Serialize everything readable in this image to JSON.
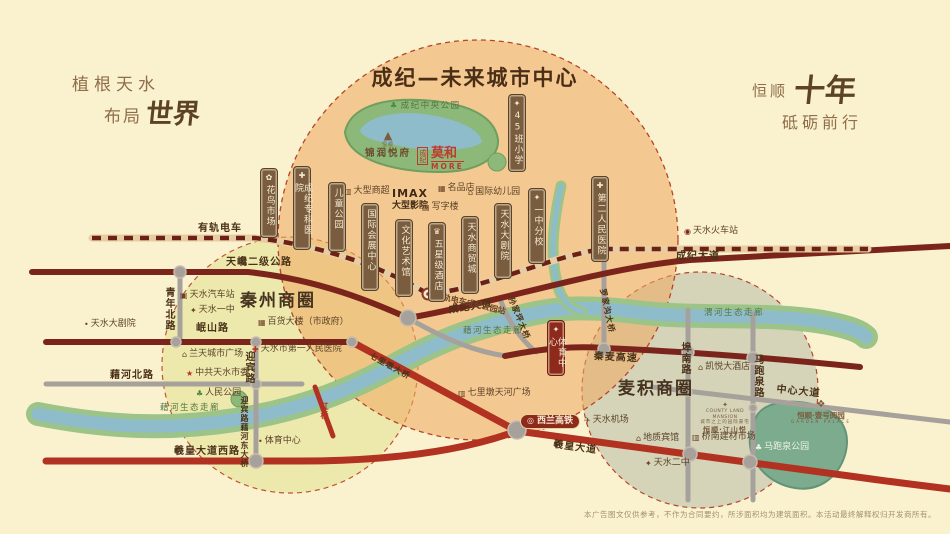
{
  "slogans": {
    "left_line1": "植根天水",
    "left_line2_prefix": "布局",
    "left_line2_calligraphy": "世界",
    "right_prefix": "恒顺",
    "right_calligraphy": "十年",
    "right_line2": "砥砺前行"
  },
  "header": {
    "center_title": "成纪—未来城市中心"
  },
  "badges": {
    "hsr": "西兰高铁",
    "imax_line1": "IMAX",
    "imax_line2": "大型影院"
  },
  "logos": {
    "jinrun": {
      "brand": "恒顺",
      "name": "锦润悦府"
    },
    "moka": {
      "prefix": "成纪",
      "name": "莫和",
      "latin": "MORE"
    },
    "county": {
      "latin": "COUNTY LAND MANSION",
      "tagline": "城市之上的园际豪宅",
      "name": "恒顺·江山悦"
    },
    "yueyuan": {
      "name": "恒顺·壹号阅园",
      "latin": "GARDEN PALACE"
    }
  },
  "disclaimer": "本广告图文仅供参考，不作为合同要约，所涉面积均为建筑面积。本活动最终解释权归开发商所有。",
  "colors": {
    "background": "#faf2cf",
    "center_circle": "#eea75f",
    "qinzhou_circle": "#e0e08c",
    "maiji_circle": "#b0b6a2",
    "circle_border": "#b5452c",
    "road_major": "#7b241c",
    "road_artery": "#b23222",
    "road_minor": "#a7a19b",
    "tram_dash": "#6d2014",
    "river_water": "#8fbccb",
    "river_bank": "#9cc489",
    "park_green": "#8cb97a",
    "park_teal": "#7cab8e",
    "plaque_brown": "#7a5c3e",
    "plaque_red": "#8d2a1c",
    "logo_red": "#c0392b",
    "text_dark": "#4a3118",
    "slogan_brown": "#8f6e49",
    "disclaimer_color": "#a3906c"
  },
  "plaques": [
    {
      "text": "花鸟市场",
      "icon": "flower",
      "x": 260,
      "y": 168,
      "h": 70
    },
    {
      "text": "成纪专科医院",
      "icon": "hospital",
      "x": 293,
      "y": 166,
      "h": 84
    },
    {
      "text": "儿童公园",
      "x": 328,
      "y": 182,
      "h": 70
    },
    {
      "text": "国际会展中心",
      "x": 361,
      "y": 203,
      "h": 88
    },
    {
      "text": "文化艺术馆",
      "x": 395,
      "y": 219,
      "h": 78
    },
    {
      "text": "五星级酒店",
      "icon": "crown",
      "x": 428,
      "y": 222,
      "h": 80
    },
    {
      "text": "天水商贸城",
      "x": 461,
      "y": 216,
      "h": 78
    },
    {
      "text": "天水大剧院",
      "x": 494,
      "y": 203,
      "h": 76
    },
    {
      "text": "一中分校",
      "icon": "school",
      "x": 528,
      "y": 188,
      "h": 76
    },
    {
      "text": "第二人民医院",
      "icon": "hospital",
      "x": 591,
      "y": 176,
      "h": 86
    },
    {
      "text": "45班小学",
      "icon": "school",
      "x": 508,
      "y": 94,
      "h": 78
    },
    {
      "text": "体育中心",
      "icon": "torch",
      "x": 547,
      "y": 320,
      "h": 56,
      "variant": "red"
    }
  ],
  "map_labels": [
    {
      "name": "tram-label",
      "text": "有轨电车",
      "cls": "road",
      "x": 198,
      "y": 224
    },
    {
      "name": "road-tianchan",
      "text": "天巉二级公路",
      "cls": "road",
      "x": 226,
      "y": 258
    },
    {
      "name": "road-chengji-east",
      "text": "成纪大道",
      "cls": "road",
      "x": 676,
      "y": 252
    },
    {
      "name": "road-chengji-mid",
      "text": "成纪大道",
      "cls": "road",
      "x": 448,
      "y": 306,
      "rot": -9
    },
    {
      "name": "road-minshan",
      "text": "岷山路",
      "cls": "road",
      "x": 196,
      "y": 324
    },
    {
      "name": "road-qingnian",
      "text": "青年北路",
      "cls": "road vert",
      "x": 163,
      "y": 287
    },
    {
      "name": "road-jihe-north",
      "text": "藉河北路",
      "cls": "road",
      "x": 110,
      "y": 371
    },
    {
      "name": "road-yingbin",
      "text": "迎宾路",
      "cls": "road vert",
      "x": 243,
      "y": 351
    },
    {
      "name": "bridge-yingbin-jihe",
      "text": "迎宾路藉河东大桥",
      "cls": "road vert small",
      "x": 240,
      "y": 396
    },
    {
      "name": "road-xihuang-west",
      "text": "羲皇大道西路",
      "cls": "road",
      "x": 174,
      "y": 447
    },
    {
      "name": "road-xihuang",
      "text": "羲皇大道",
      "cls": "road",
      "x": 554,
      "y": 440,
      "rot": 8
    },
    {
      "name": "road-qinmai-expwy",
      "text": "秦麦高速",
      "cls": "road",
      "x": 594,
      "y": 352,
      "rot": 3
    },
    {
      "name": "road-zhongxin",
      "text": "中心大道",
      "cls": "road",
      "x": 777,
      "y": 385,
      "rot": 6
    },
    {
      "name": "road-bunan",
      "text": "埠南路",
      "cls": "road vert",
      "x": 679,
      "y": 342
    },
    {
      "name": "road-mapaoquan",
      "text": "马跑泉路",
      "cls": "road vert",
      "x": 752,
      "y": 354
    },
    {
      "name": "bridge-hongqiao",
      "text": "红桥",
      "cls": "road vert red small",
      "x": 320,
      "y": 402
    },
    {
      "name": "bridge-qilidun",
      "text": "七里墩大桥",
      "cls": "road small",
      "x": 372,
      "y": 352,
      "rot": 29
    },
    {
      "name": "bridge-sunjiaping",
      "text": "孙家坪大桥",
      "cls": "road small",
      "x": 514,
      "y": 296,
      "rot": 68
    },
    {
      "name": "bridge-luojiagou",
      "text": "罗家沟大桥",
      "cls": "road small",
      "x": 606,
      "y": 288,
      "rot": 78
    },
    {
      "name": "tram-station-label",
      "text": "有轨电车成纪公园站",
      "cls": "station",
      "x": 436,
      "y": 292,
      "rot": 13
    },
    {
      "name": "qinzhou-circle-label",
      "text": "秦州商圈",
      "cls": "big",
      "x": 240,
      "y": 293
    },
    {
      "name": "maiji-circle-label",
      "text": "麦积商圈",
      "cls": "big",
      "x": 618,
      "y": 381
    },
    {
      "name": "river-jihe-corridor-1",
      "text": "藉河生态走廊",
      "cls": "river",
      "x": 160,
      "y": 404
    },
    {
      "name": "river-jihe-corridor-2",
      "text": "藉河生态走廊",
      "cls": "river",
      "x": 463,
      "y": 327
    },
    {
      "name": "river-weihe-corridor",
      "text": "渭河生态走廊",
      "cls": "river",
      "x": 704,
      "y": 309
    },
    {
      "name": "park-chengji-central",
      "text": "成纪中央公园",
      "cls": "river",
      "icon": "tree",
      "x": 390,
      "y": 102
    },
    {
      "name": "poi-grand-theater",
      "text": "天水大剧院",
      "cls": "poi",
      "icon": "dot",
      "x": 84,
      "y": 320
    },
    {
      "name": "poi-bus-station",
      "text": "天水汽车站",
      "cls": "poi",
      "icon": "bus",
      "x": 180,
      "y": 291
    },
    {
      "name": "poi-no1-middle-school",
      "text": "天水一中",
      "cls": "poi",
      "icon": "school",
      "x": 190,
      "y": 306
    },
    {
      "name": "poi-department-store",
      "text": "百货大楼（市政府）",
      "cls": "poi",
      "icon": "shop",
      "x": 258,
      "y": 318
    },
    {
      "name": "poi-lantian-plaza",
      "text": "兰天城市广场",
      "cls": "poi",
      "icon": "building",
      "x": 182,
      "y": 350
    },
    {
      "name": "poi-first-peoples-hospital",
      "text": "天水市第一人民医院",
      "cls": "poi",
      "icon": "hospital",
      "x": 252,
      "y": 345
    },
    {
      "name": "poi-municipal-committee",
      "text": "中共天水市委",
      "cls": "poi",
      "icon": "star",
      "x": 186,
      "y": 369
    },
    {
      "name": "poi-peoples-park",
      "text": "人民公园",
      "cls": "poi",
      "icon": "tree",
      "x": 196,
      "y": 389
    },
    {
      "name": "poi-sports-center-west",
      "text": "体育中心",
      "cls": "poi",
      "icon": "dot",
      "x": 258,
      "y": 437
    },
    {
      "name": "poi-supermarket",
      "text": "大型商超",
      "cls": "poi",
      "icon": "cart",
      "x": 344,
      "y": 187
    },
    {
      "name": "poi-boutique-store",
      "text": "名品店",
      "cls": "poi",
      "icon": "shop",
      "x": 438,
      "y": 184
    },
    {
      "name": "poi-intl-kindergarten",
      "text": "国际幼儿园",
      "cls": "poi",
      "icon": "building",
      "x": 468,
      "y": 188
    },
    {
      "name": "poi-office-tower",
      "text": "写字楼",
      "cls": "poi",
      "icon": "office",
      "x": 422,
      "y": 203
    },
    {
      "name": "poi-railway-station",
      "text": "天水火车站",
      "cls": "poi",
      "icon": "train",
      "x": 684,
      "y": 227
    },
    {
      "name": "poi-airport",
      "text": "天水机场",
      "cls": "poi",
      "icon": "plane",
      "x": 584,
      "y": 416
    },
    {
      "name": "poi-tianhe-plaza",
      "text": "七里墩天河广场",
      "cls": "poi",
      "icon": "cart",
      "x": 458,
      "y": 389
    },
    {
      "name": "poi-kaiyue-hotel",
      "text": "凯悦大酒店",
      "cls": "poi",
      "icon": "building",
      "x": 698,
      "y": 363
    },
    {
      "name": "poi-dizhi-hotel",
      "text": "地质宾馆",
      "cls": "poi",
      "icon": "building",
      "x": 636,
      "y": 434
    },
    {
      "name": "poi-qiaonan-market",
      "text": "桥南建材市场",
      "cls": "poi",
      "icon": "cart",
      "x": 692,
      "y": 433
    },
    {
      "name": "poi-no2-middle-school",
      "text": "天水二中",
      "cls": "poi",
      "icon": "school",
      "x": 645,
      "y": 459
    },
    {
      "name": "poi-mapaoquan-park",
      "text": "马跑泉公园",
      "cls": "poi onpark",
      "icon": "tree",
      "x": 755,
      "y": 443
    }
  ]
}
